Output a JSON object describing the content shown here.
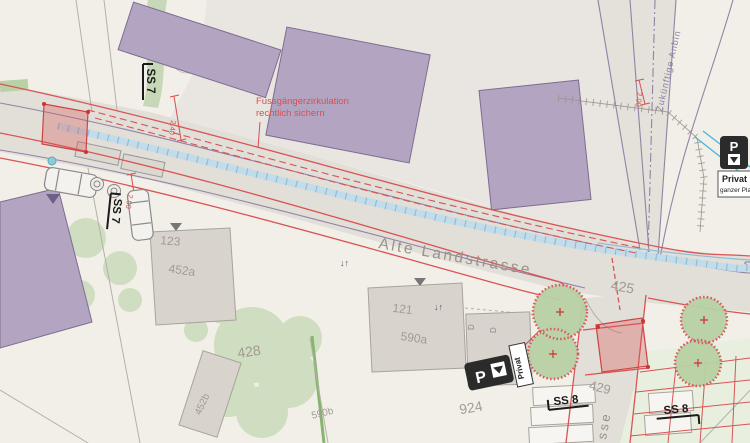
{
  "streets": {
    "main_label": "Alte Landstrasse",
    "side_fragment": "sse"
  },
  "annotations": {
    "pedestrian_note_line1": "Fussgängerzirkulation",
    "pedestrian_note_line2": "rechtlich sichern",
    "future_connection": "Zukünftige Anbin",
    "dim_top": "2.40",
    "dim_left": "2.00",
    "dim_right": "2.00"
  },
  "parcels": {
    "p123": "123",
    "p452a": "452a",
    "p428": "428",
    "p452b": "452b",
    "p121": "121",
    "p590a": "590a",
    "p590b": "590b",
    "p924": "924",
    "p429": "429",
    "p425": "425"
  },
  "signs": {
    "ss7_top": "SS 7",
    "ss7_left": "SS 7",
    "ss8_left": "SS 8",
    "ss8_right": "SS 8",
    "parking_letter_right": "P",
    "parking_letter_bottom": "P",
    "parking_right_line1": "Privat",
    "parking_right_line2": "ganzer Pla",
    "parking_bottom_label": "Privat"
  },
  "symbols": {
    "entrance_arrows": "↓↑",
    "door_symbol": "D"
  },
  "colors": {
    "background": "#f2efe9",
    "new_building": "#b3a5c2",
    "existing_building": "#d8d4cd",
    "road": "#e2ded8",
    "project_red": "#d95454",
    "tree_green": "#ccdcbc",
    "new_tree_green": "#b9d1a5",
    "water_blue": "#9fc6dc",
    "cyan_line": "#49b8d8",
    "purple_line": "#9183a5"
  }
}
